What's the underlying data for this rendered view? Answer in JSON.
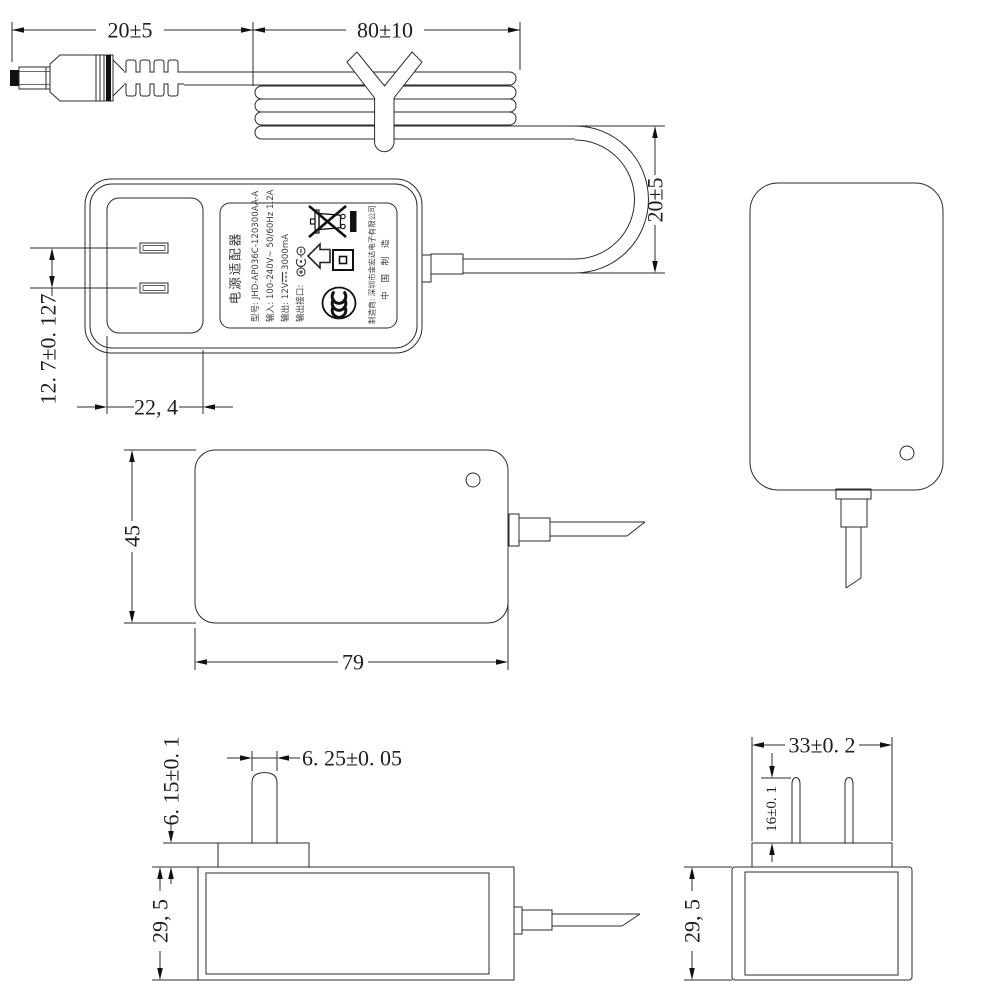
{
  "drawing": {
    "dims": {
      "cord_plug_length": "20±5",
      "cord_coil_length": "80±10",
      "cord_loop_height": "20±5",
      "prong_pitch": "12. 7±0. 127",
      "recess_width": "22, 4",
      "body_height": "45",
      "body_length": "79",
      "prong_width": "6. 25±0. 05",
      "plug_base_height": "6. 15±0. 1",
      "body_depth_side": "29, 5",
      "plug_base_width": "33±0. 2",
      "prong_length": "16±0. 1",
      "body_depth_end": "29, 5"
    },
    "label": {
      "title": "电源适配器",
      "model": "型号: JHD-AP036C-120300AA-A",
      "input": "输入: 100-240V~ 50/60Hz 1.2A",
      "output_prefix": "输出: 12V",
      "output_suffix": "3000mA",
      "port": "输出接口:",
      "manufacturer": "制造商: 深圳市金宏达电子有限公司",
      "origin": "中 国 制 造"
    },
    "icons": {
      "weee": "crossed-out-wheeled-bin",
      "class_ii": "double-square",
      "indoor_use": "house-arrow",
      "ccc": "ccc-certification-mark",
      "polarity": "center-positive-polarity",
      "dc": "dc-voltage-symbol"
    },
    "colors": {
      "line": "#2b2b2b",
      "background": "#ffffff"
    }
  }
}
